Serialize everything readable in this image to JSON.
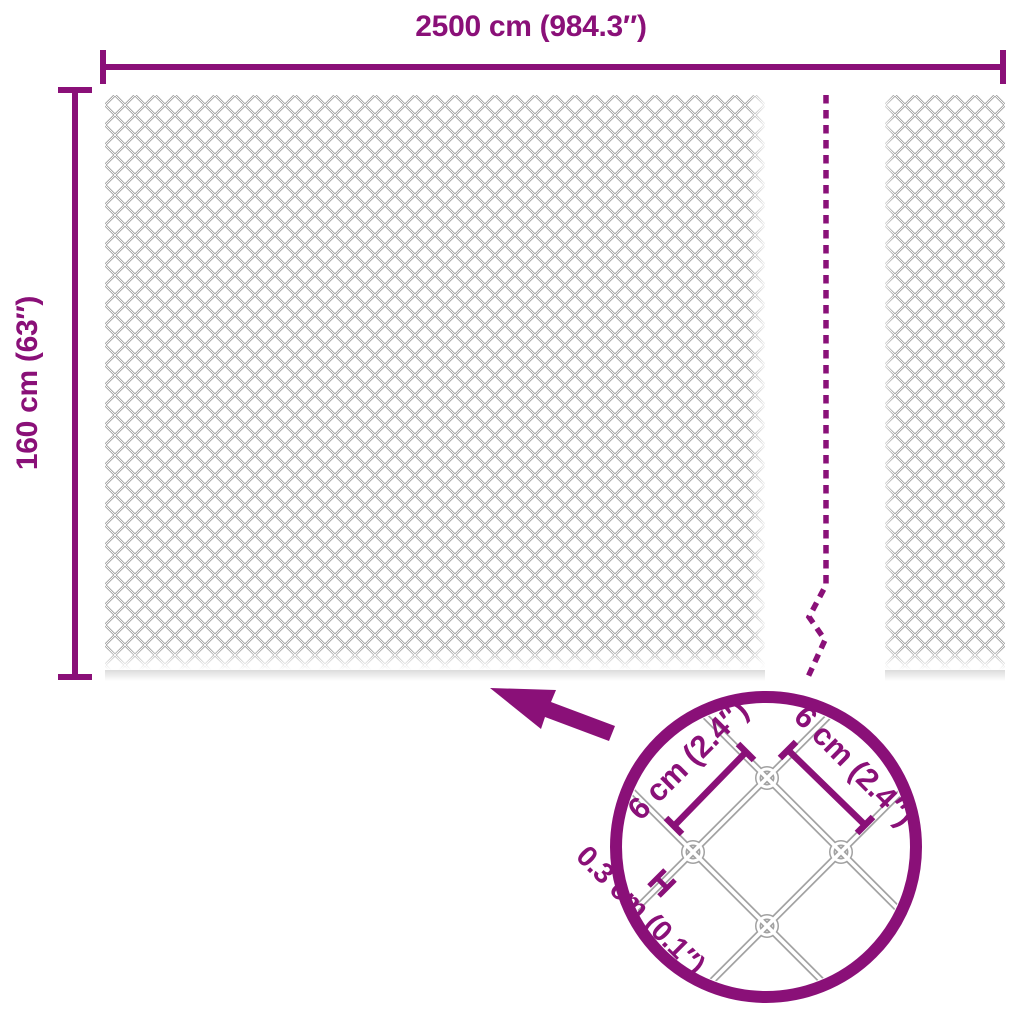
{
  "colors": {
    "accent": "#8a1078",
    "wire_gray": "#8c8c8c"
  },
  "fence": {
    "width_label": "2500 cm (984.3″)",
    "height_label": "160 cm (63″)"
  },
  "detail_callout": {
    "mesh_opening_left_label": "6 cm (2.4″)",
    "mesh_opening_right_label": "6 cm (2.4″)",
    "wire_thickness_label": "0.3 cm (0.1″)"
  }
}
